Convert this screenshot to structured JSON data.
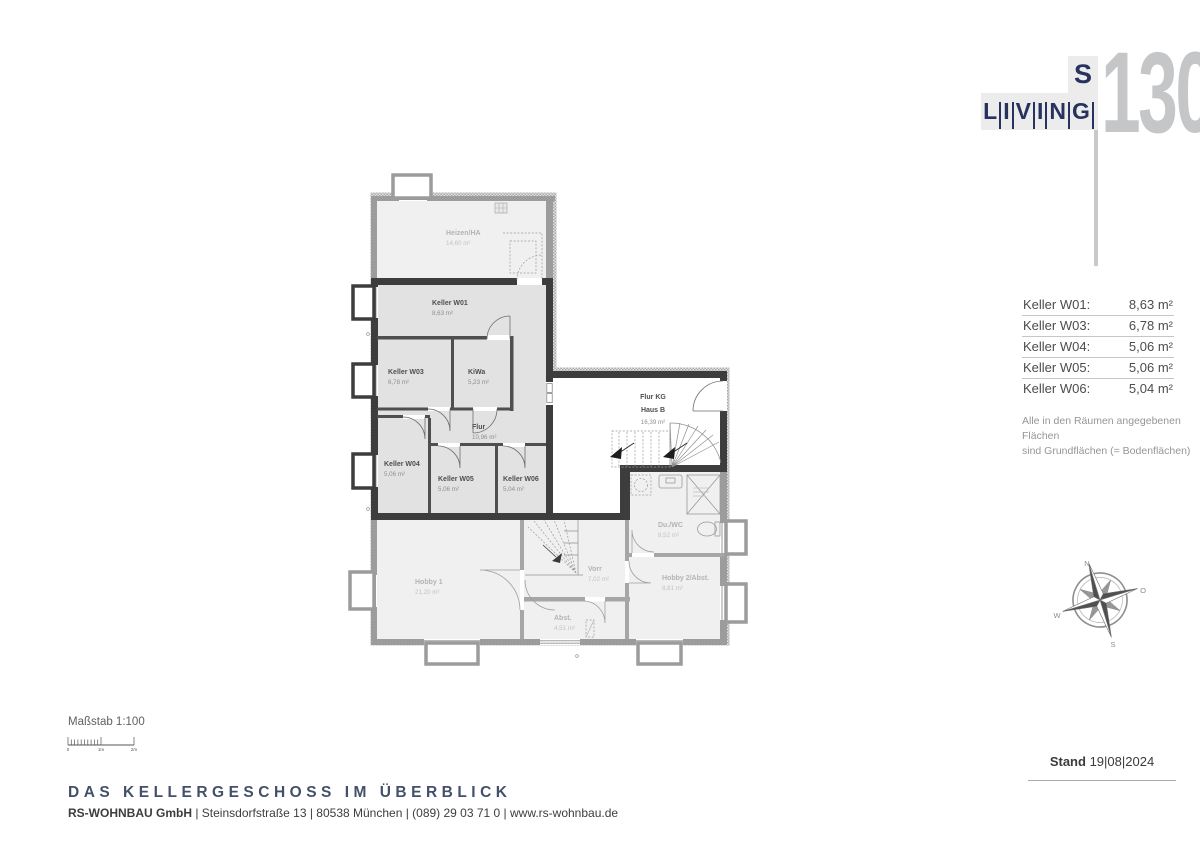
{
  "logo": {
    "living": "LIVING",
    "s": "S",
    "number": "130"
  },
  "area_table": {
    "rows": [
      {
        "label": "Keller W01:",
        "value": "8,63 m²"
      },
      {
        "label": "Keller W03:",
        "value": "6,78 m²"
      },
      {
        "label": "Keller W04:",
        "value": "5,06 m²"
      },
      {
        "label": "Keller W05:",
        "value": "5,06 m²"
      },
      {
        "label": "Keller W06:",
        "value": "5,04 m²"
      }
    ],
    "note_line1": "Alle in den Räumen angegebenen Flächen",
    "note_line2": "sind Grundflächen (= Bodenflächen)"
  },
  "compass": {
    "north": "N",
    "east": "O",
    "south": "S",
    "west": "W"
  },
  "stand": {
    "label": "Stand",
    "date": "19|08|2024"
  },
  "scalebar": {
    "label": "Maßstab 1:100",
    "tick0": "0",
    "tick1": "1m",
    "tick2": "2m"
  },
  "footer": {
    "title": "DAS KELLERGESCHOSS IM ÜBERBLICK",
    "company": "RS-WOHNBAU GmbH",
    "address": "| Steinsdorfstraße 13 |  80538 München | (089) 29 03 71 0 | www.rs-wohnbau.de"
  },
  "plan": {
    "rooms": [
      {
        "id": "heizen",
        "name": "Heizen/HA",
        "area": "14,60 m²",
        "x": 106,
        "y": 70,
        "cls": "mu"
      },
      {
        "id": "keller-w01",
        "name": "Keller W01",
        "area": "8,63 m²",
        "x": 92,
        "y": 140,
        "cls": "hl"
      },
      {
        "id": "keller-w03",
        "name": "Keller W03",
        "area": "6,78 m²",
        "x": 48,
        "y": 209,
        "cls": "hl"
      },
      {
        "id": "kiwa",
        "name": "KiWa",
        "area": "5,23 m²",
        "x": 128,
        "y": 209,
        "cls": "hl"
      },
      {
        "id": "flur",
        "name": "Flur",
        "area": "10,96 m²",
        "x": 132,
        "y": 264,
        "cls": "hl"
      },
      {
        "id": "keller-w04",
        "name": "Keller W04",
        "area": "5,06 m²",
        "x": 44,
        "y": 301,
        "cls": "hl"
      },
      {
        "id": "keller-w05",
        "name": "Keller W05",
        "area": "5,06 m²",
        "x": 98,
        "y": 316,
        "cls": "hl"
      },
      {
        "id": "keller-w06",
        "name": "Keller W06",
        "area": "5,04 m²",
        "x": 163,
        "y": 316,
        "cls": "hl"
      },
      {
        "id": "flur-kg",
        "name": "Flur KG",
        "name2": "Haus B",
        "area": "16,39 m²",
        "x": 313,
        "y": 234,
        "cls": "hl",
        "anchor": "middle"
      },
      {
        "id": "du-wc",
        "name": "Du./WC",
        "area": "8,52 m²",
        "x": 318,
        "y": 362,
        "cls": "mu"
      },
      {
        "id": "hobby1",
        "name": "Hobby 1",
        "area": "21,20 m²",
        "x": 75,
        "y": 419,
        "cls": "mu"
      },
      {
        "id": "vorr",
        "name": "Vorr",
        "area": "7,02 m²",
        "x": 248,
        "y": 406,
        "cls": "mu"
      },
      {
        "id": "hobby2",
        "name": "Hobby 2/Abst.",
        "area": "8,81 m²",
        "x": 322,
        "y": 415,
        "cls": "mu"
      },
      {
        "id": "abst",
        "name": "Abst.",
        "area": "4,51 m²",
        "x": 214,
        "y": 455,
        "cls": "mu"
      }
    ]
  }
}
